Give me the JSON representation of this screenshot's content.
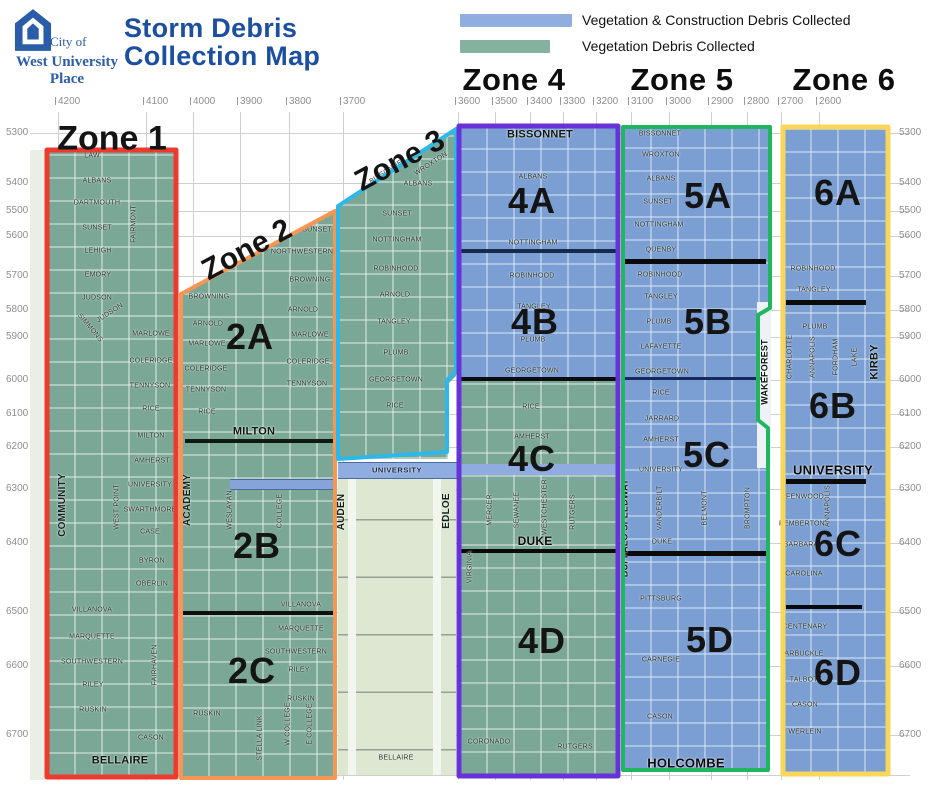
{
  "header": {
    "logo": {
      "line1": "City of",
      "line2": "West University",
      "line3": "Place"
    },
    "title_line1": "Storm Debris",
    "title_line2": "Collection Map",
    "legend_blue": "Vegetation & Construction Debris Collected",
    "legend_green": "Vegetation Debris Collected",
    "zone4": "Zone 4",
    "zone5": "Zone 5",
    "zone6": "Zone 6"
  },
  "map_labels": {
    "zone1": "Zone 1",
    "zone2": "Zone 2",
    "zone3": "Zone 3"
  },
  "subzones": {
    "z2a": "2A",
    "z2b": "2B",
    "z2c": "2C",
    "z4a": "4A",
    "z4b": "4B",
    "z4c": "4C",
    "z4d": "4D",
    "z5a": "5A",
    "z5b": "5B",
    "z5c": "5C",
    "z5d": "5D",
    "z6a": "6A",
    "z6b": "6B",
    "z6c": "6C",
    "z6d": "6D"
  },
  "axis": {
    "top": [
      "4200",
      "4100",
      "4000",
      "3900",
      "3800",
      "3700",
      "3600",
      "3500",
      "3400",
      "3300",
      "3200",
      "3100",
      "3000",
      "2900",
      "2800",
      "2700",
      "2600"
    ],
    "left": [
      "5300",
      "5400",
      "5500",
      "5600",
      "5700",
      "5800",
      "5900",
      "6000",
      "6100",
      "6200",
      "6300",
      "6400",
      "6500",
      "6600",
      "6700"
    ],
    "right": [
      "5300",
      "5400",
      "5500",
      "5600",
      "5700",
      "5800",
      "5900",
      "6000",
      "6100",
      "6200",
      "6300",
      "6400",
      "6500",
      "6600",
      "6700"
    ]
  },
  "streets": {
    "z1": {
      "law": "LAW",
      "albans": "ALBANS",
      "dartmouth": "DARTMOUTH",
      "sunset": "SUNSET",
      "lehigh": "LEHIGH",
      "emory": "EMORY",
      "judson": "JUDSON",
      "fairmont": "FAIRMONT",
      "simmons": "SIMMONS",
      "marlowe": "MARLOWE",
      "coleridge": "COLERIDGE",
      "tennyson": "TENNYSON",
      "rice": "RICE",
      "milton": "MILTON",
      "amherst": "AMHERST",
      "university": "UNIVERSITY",
      "swarthmore": "SWARTHMORE",
      "case": "CASE",
      "byron": "BYRON",
      "oberlin": "OBERLIN",
      "villanova": "VILLANOVA",
      "marquette": "MARQUETTE",
      "southwestern": "SOUTHWESTERN",
      "riley": "RILEY",
      "ruskin": "RUSKIN",
      "fairhaven": "FAIRHAVEN",
      "cason": "CASON",
      "community": "COMMUNITY",
      "west_point": "WEST POINT",
      "bellaire": "BELLAIRE"
    },
    "z2": {
      "sunset": "SUNSET",
      "northwestern": "NORTHWESTERN",
      "browning": "BROWNING",
      "arnold": "ARNOLD",
      "marlowe": "MARLOWE",
      "coleridge": "COLERIDGE",
      "tennyson": "TENNYSON",
      "rice": "RICE",
      "milton": "MILTON",
      "academy": "ACADEMY",
      "weslayan": "WESLAYAN",
      "college": "COLLEGE",
      "villanova": "VILLANOVA",
      "marquette": "MARQUETTE",
      "southwestern": "SOUTHWESTERN",
      "riley": "RILEY",
      "ruskin": "RUSKIN",
      "stella_link": "STELLA LINK",
      "w_college": "W COLLEGE",
      "e_college": "E COLLEGE"
    },
    "z3": {
      "bissonnet": "BISSONNET",
      "wroxton": "WROXTON",
      "albans": "ALBANS",
      "sunset": "SUNSET",
      "nottingham": "NOTTINGHAM",
      "robinhood": "ROBINHOOD",
      "arnold": "ARNOLD",
      "tangley": "TANGLEY",
      "plumb": "PLUMB",
      "georgetown": "GEORGETOWN",
      "rice": "RICE"
    },
    "mid": {
      "university": "UNIVERSITY",
      "auden": "AUDEN",
      "edloe": "EDLOE",
      "bellaire": "BELLAIRE"
    },
    "z4": {
      "bissonnet": "BISSONNET",
      "albans": "ALBANS",
      "nottingham": "NOTTINGHAM",
      "robinhood": "ROBINHOOD",
      "tangley": "TANGLEY",
      "plumb": "PLUMB",
      "georgetown": "GEORGETOWN",
      "rice": "RICE",
      "amherst": "AMHERST",
      "mercer": "MERCER",
      "sewanee": "SEWANEE",
      "westchester": "WESTCHESTER",
      "rutgers": "RUTGERS",
      "virginia": "VIRGINIA",
      "duke": "DUKE",
      "coronado": "CORONADO"
    },
    "z5": {
      "bissonnet": "BISSONNET",
      "wroxton": "WROXTON",
      "albans": "ALBANS",
      "sunset": "SUNSET",
      "nottingham": "NOTTINGHAM",
      "quenby": "QUENBY",
      "robinhood": "ROBINHOOD",
      "tangley": "TANGLEY",
      "plumb": "PLUMB",
      "lafayette": "LAFAYETTE",
      "georgetown": "GEORGETOWN",
      "rice": "RICE",
      "jarrard": "JARRARD",
      "amherst": "AMHERST",
      "university": "UNIVERSITY",
      "vanderbilt": "VANDERBILT",
      "belmont": "BELMONT",
      "brompton": "BROMPTON",
      "duke": "DUKE",
      "pittsburg": "PITTSBURG",
      "carnegie": "CARNEGIE",
      "cason": "CASON",
      "holcombe": "HOLCOMBE",
      "buffalo_speedway": "BUFFALO SPEEDWAY",
      "wakeforest": "WAKEFOREST"
    },
    "z6": {
      "robinhood": "ROBINHOOD",
      "tangley": "TANGLEY",
      "plumb": "PLUMB",
      "charlotte": "CHARLOTTE",
      "annapolis": "ANNAPOLIS",
      "fordham": "FORDHAM",
      "lake": "LAKE",
      "kirby": "KIRBY",
      "university": "UNIVERSITY",
      "fenwood": "FENWOOD",
      "pemberton": "PEMBERTON",
      "barbara": "BARBARA",
      "carolina": "CAROLINA",
      "centenary": "CENTENARY",
      "arbuckle": "ARBUCKLE",
      "talbott": "TALBOTT",
      "cason": "CASON",
      "werlein": "WERLEIN"
    }
  },
  "colors": {
    "title_blue": "#1d4fa1",
    "logo_blue": "#2b5ca8",
    "legend_blue": "#8fadde",
    "legend_green": "#84b29e",
    "green_zone_fill": "#7ba796",
    "blue_zone_fill": "#7b9ed3",
    "zone1_outline": "#ee3a2c",
    "zone2_outline": "#f79552",
    "zone3_outline": "#2cb8e8",
    "zone4_outline": "#6733d9",
    "zone5_outline": "#21b55f",
    "zone6_outline": "#f8d65a"
  }
}
